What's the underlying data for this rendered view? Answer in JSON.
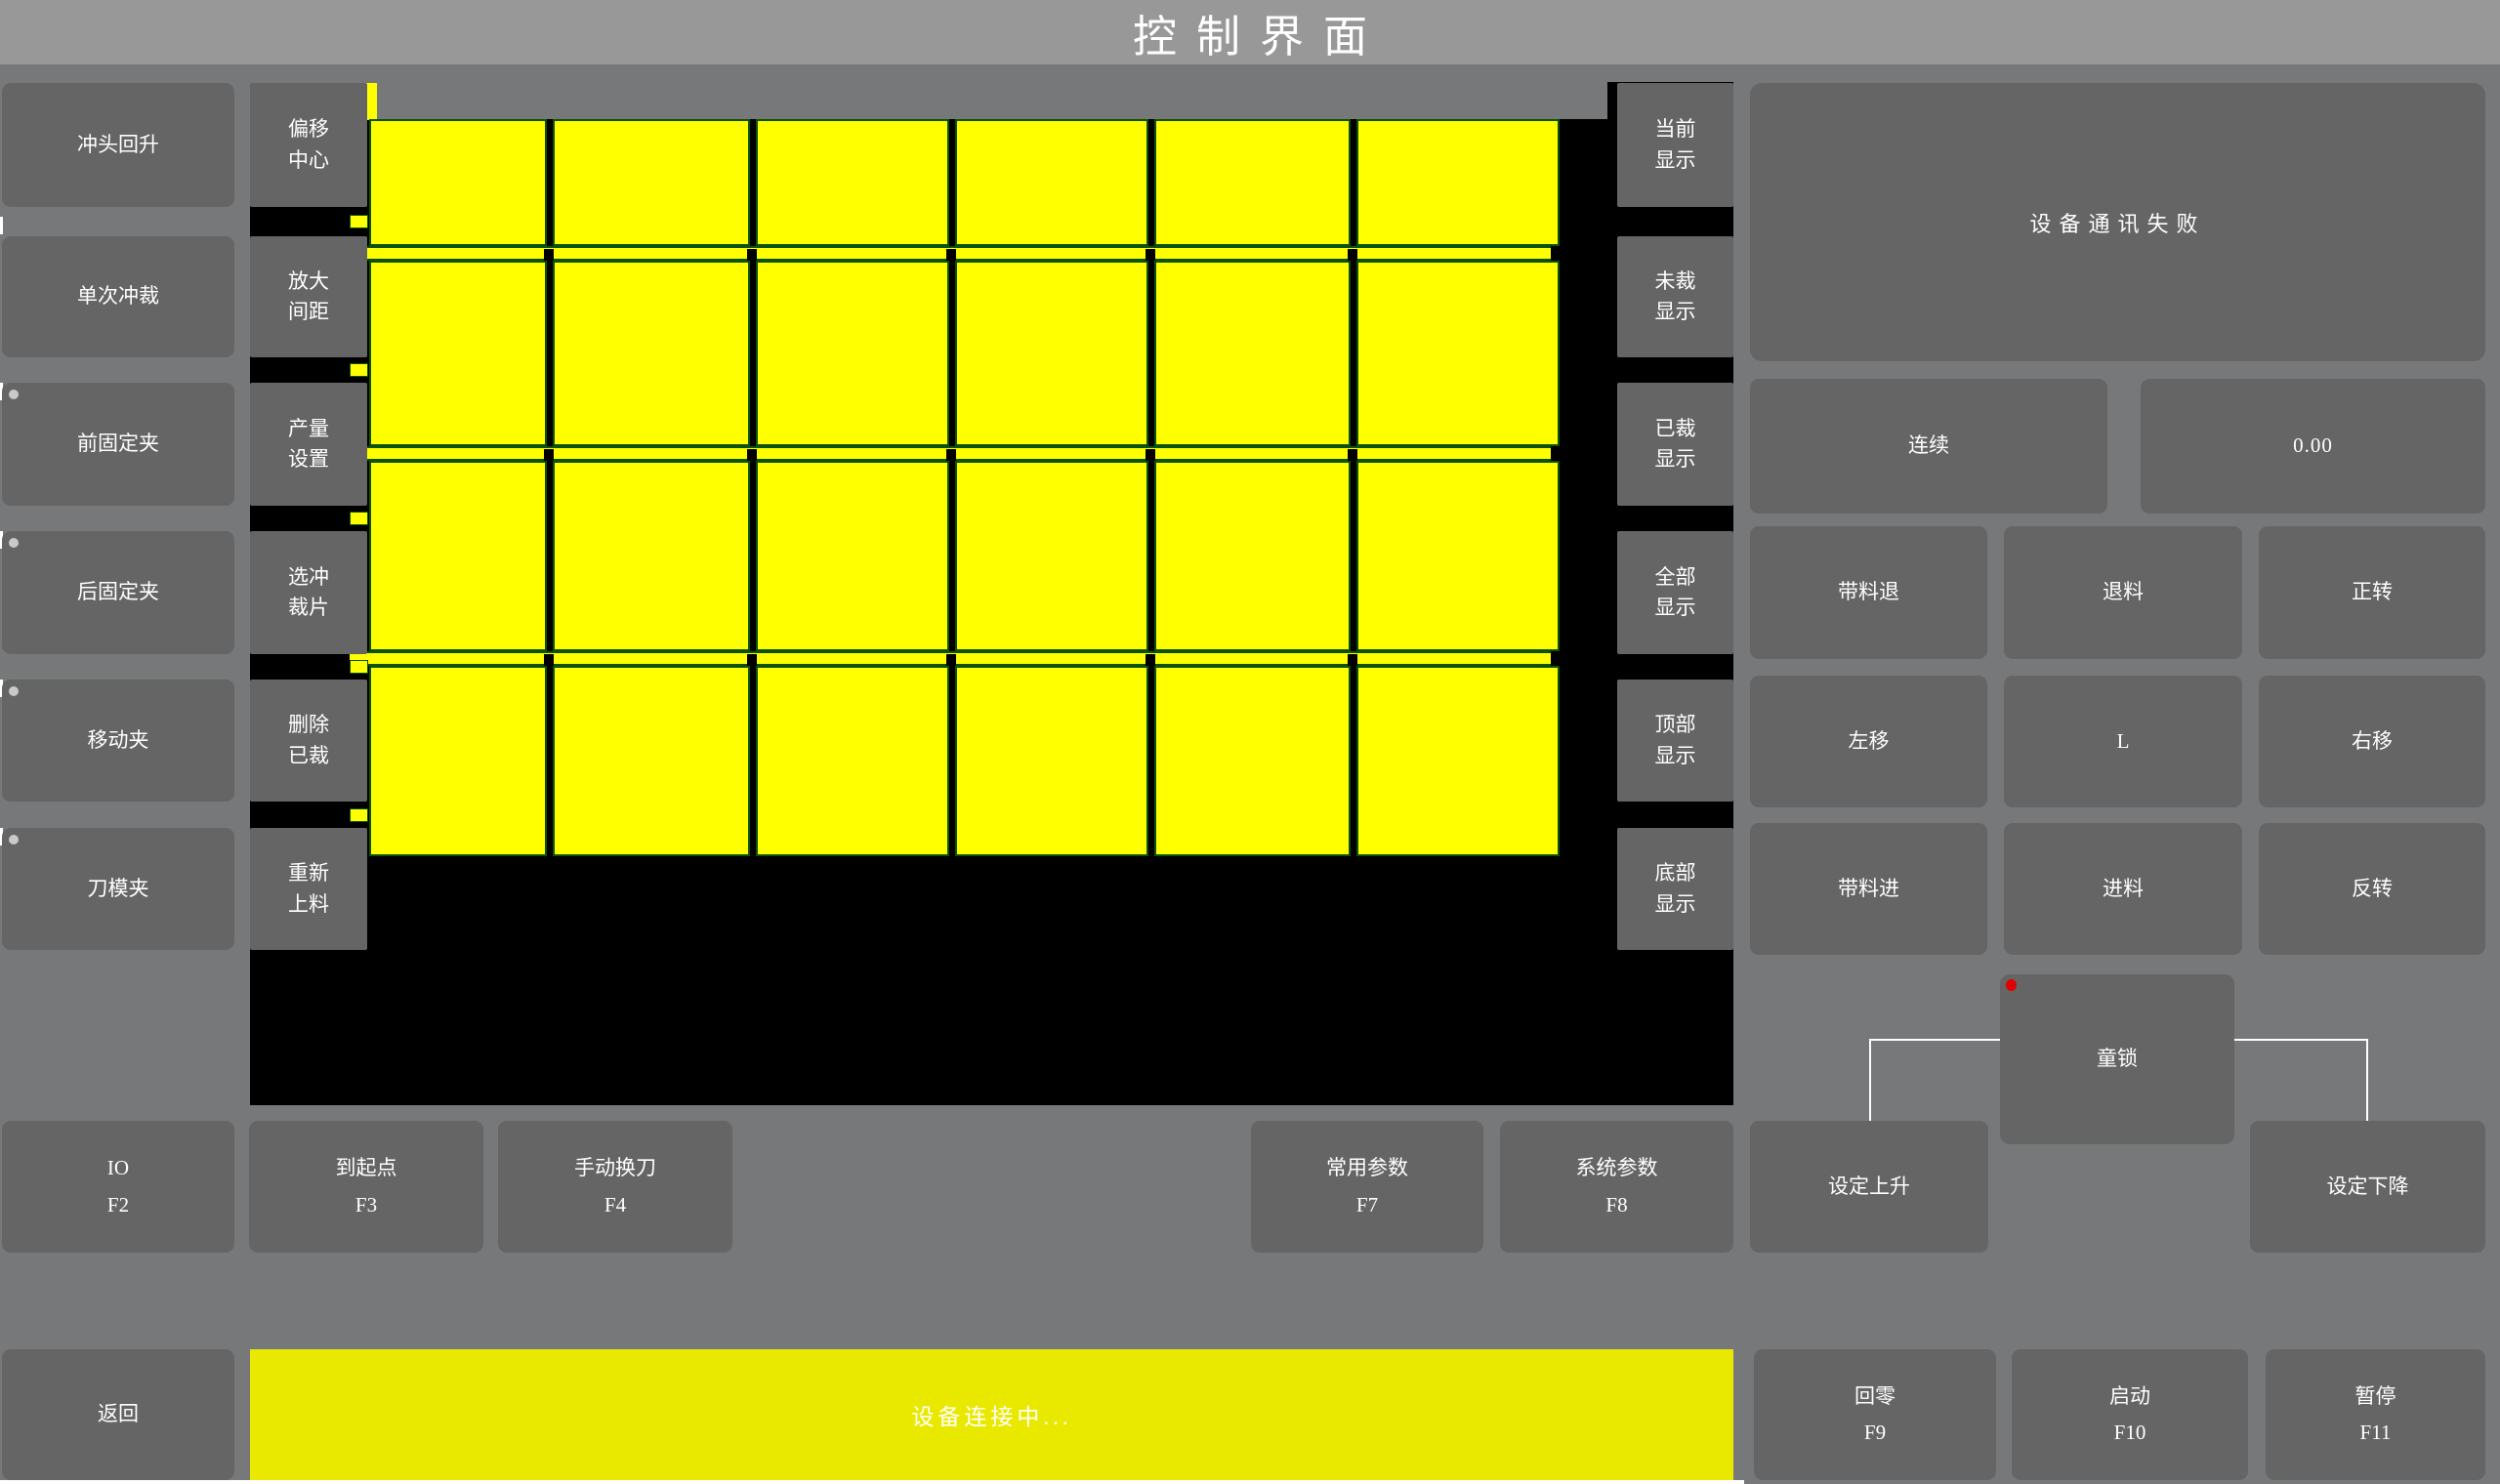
{
  "title": "控制界面",
  "left_panel": {
    "buttons": [
      "冲头回升",
      "单次冲裁",
      "前固定夹",
      "后固定夹",
      "移动夹",
      "刀模夹"
    ]
  },
  "tool_panel": {
    "buttons": [
      "偏移\n中心",
      "放大\n间距",
      "产量\n设置",
      "选冲\n裁片",
      "删除\n已裁",
      "重新\n上料"
    ]
  },
  "display_panel": {
    "buttons": [
      "当前\n显示",
      "未裁\n显示",
      "已裁\n显示",
      "全部\n显示",
      "顶部\n显示",
      "底部\n显示"
    ]
  },
  "material_view": {
    "rows": 4,
    "cols": 6,
    "piece_count": 24,
    "piece_color": "#ffff00",
    "outline_color": "#0b530b",
    "background_color": "#000000"
  },
  "right_panel": {
    "status_message": "设备通讯失败",
    "mode_button": "连续",
    "value_display": "0.00",
    "jog_buttons": [
      "带料退",
      "退料",
      "正转",
      "左移",
      "L",
      "右移",
      "带料进",
      "进料",
      "反转"
    ],
    "child_lock": {
      "label": "童锁",
      "indicator_color": "#e00000"
    }
  },
  "function_row": {
    "io": {
      "label": "IO",
      "key": "F2"
    },
    "origin": {
      "label": "到起点",
      "key": "F3"
    },
    "tool_change": {
      "label": "手动换刀",
      "key": "F4"
    },
    "common_params": {
      "label": "常用参数",
      "key": "F7"
    },
    "system_params": {
      "label": "系统参数",
      "key": "F8"
    },
    "set_up": "设定上升",
    "set_down": "设定下降"
  },
  "bottom_bar": {
    "back": "返回",
    "status": "设备连接中...",
    "status_color": "#e9e900",
    "zero": {
      "label": "回零",
      "key": "F9"
    },
    "start": {
      "label": "启动",
      "key": "F10"
    },
    "pause": {
      "label": "暂停",
      "key": "F11"
    }
  }
}
